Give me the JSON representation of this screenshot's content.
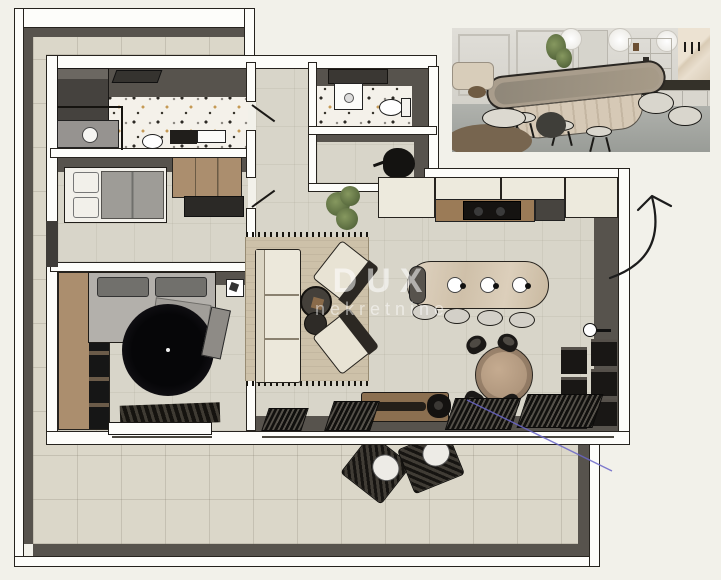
{
  "scene": {
    "type": "apartment-floor-plan-3d-top-view",
    "watermark": {
      "line1": "DUX",
      "line2": "nekretnine"
    }
  },
  "palette": {
    "background": "#f2f1ea",
    "outer_wall_white": "#fdfdfa",
    "wall_dark_face": "#57534d",
    "outline_black": "#26231e",
    "terrace_floor": "#dbd7c9",
    "interior_floor": "#d8d5c9",
    "bathroom_terrazzo": "#f4f1ea",
    "wood": "#ab8e6e",
    "cream_cabinets": "#edeadd",
    "island_marble": "#dbcfbc",
    "living_rug": "#cdc1a9",
    "dark_furniture": "#1b1917",
    "round_rug": "#0a090c",
    "annotation_arrow": "#1c1c1c",
    "annotation_blue_line": "#6a66c8"
  },
  "plan": {
    "rooms": [
      {
        "name": "bathroom"
      },
      {
        "name": "bedroom-1"
      },
      {
        "name": "bedroom-2"
      },
      {
        "name": "hallway"
      },
      {
        "name": "wc"
      },
      {
        "name": "storage"
      },
      {
        "name": "kitchen"
      },
      {
        "name": "living-room"
      },
      {
        "name": "dining-area"
      },
      {
        "name": "terrace"
      }
    ]
  },
  "inset": {
    "content": "kitchen-interior-3d-render"
  }
}
